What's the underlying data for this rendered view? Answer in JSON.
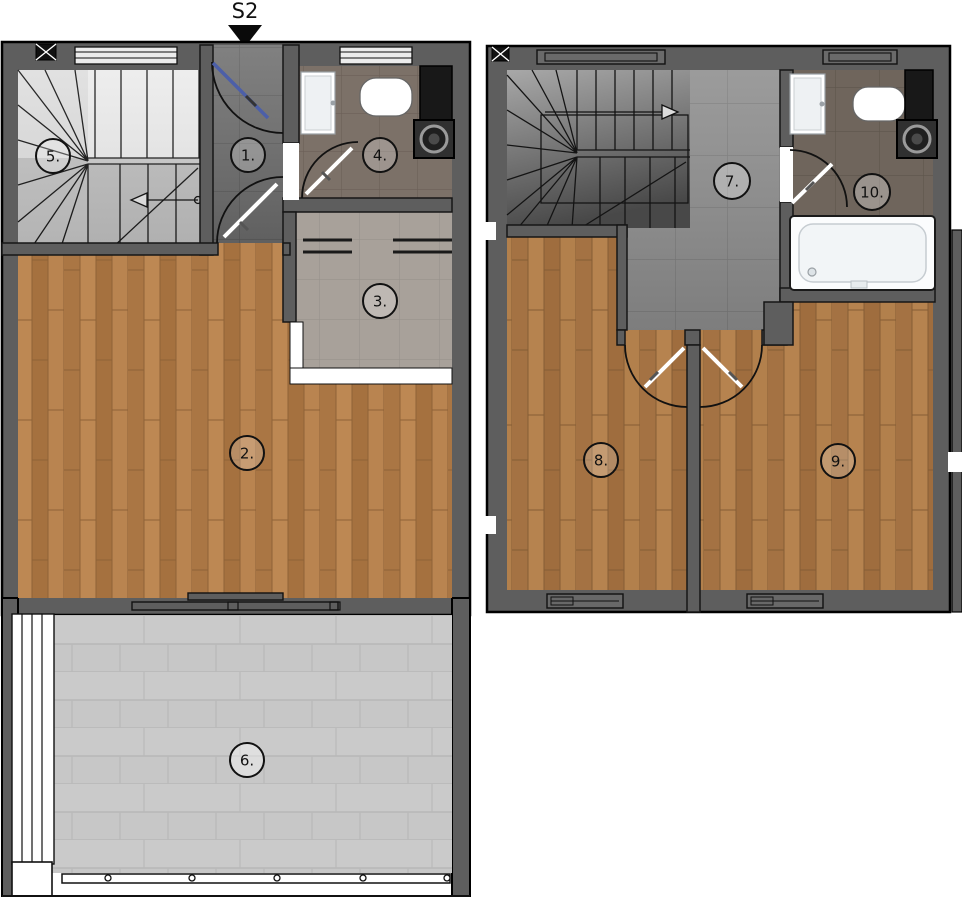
{
  "marker": {
    "label": "S2"
  },
  "rooms": {
    "r1": "1.",
    "r2": "2.",
    "r3": "3.",
    "r4": "4.",
    "r5": "5.",
    "r6": "6.",
    "r7": "7.",
    "r8": "8.",
    "r9": "9.",
    "r10": "10."
  },
  "floors": {
    "lower": {
      "room_ids": [
        "1.",
        "2.",
        "3.",
        "4.",
        "5.",
        "6."
      ]
    },
    "upper": {
      "room_ids": [
        "7.",
        "8.",
        "9.",
        "10."
      ]
    }
  },
  "colors": {
    "wall": "#5e5e5e",
    "wood_lower": "#b37e4b",
    "wood_upper": "#ad7a4b",
    "tile_entry": "#6f6f6f",
    "tile_hall": "#8f8f8f",
    "tile_kitchen": "#a8a19a",
    "bath_floor_lower": "#7c7168",
    "bath_floor_upper": "#6f655c",
    "terrace_paver": "#c7c7c7",
    "door_leaf_accent": "#4c5fa8",
    "fixture_white": "#fbfcfd",
    "appliance_dark": "#181818"
  }
}
